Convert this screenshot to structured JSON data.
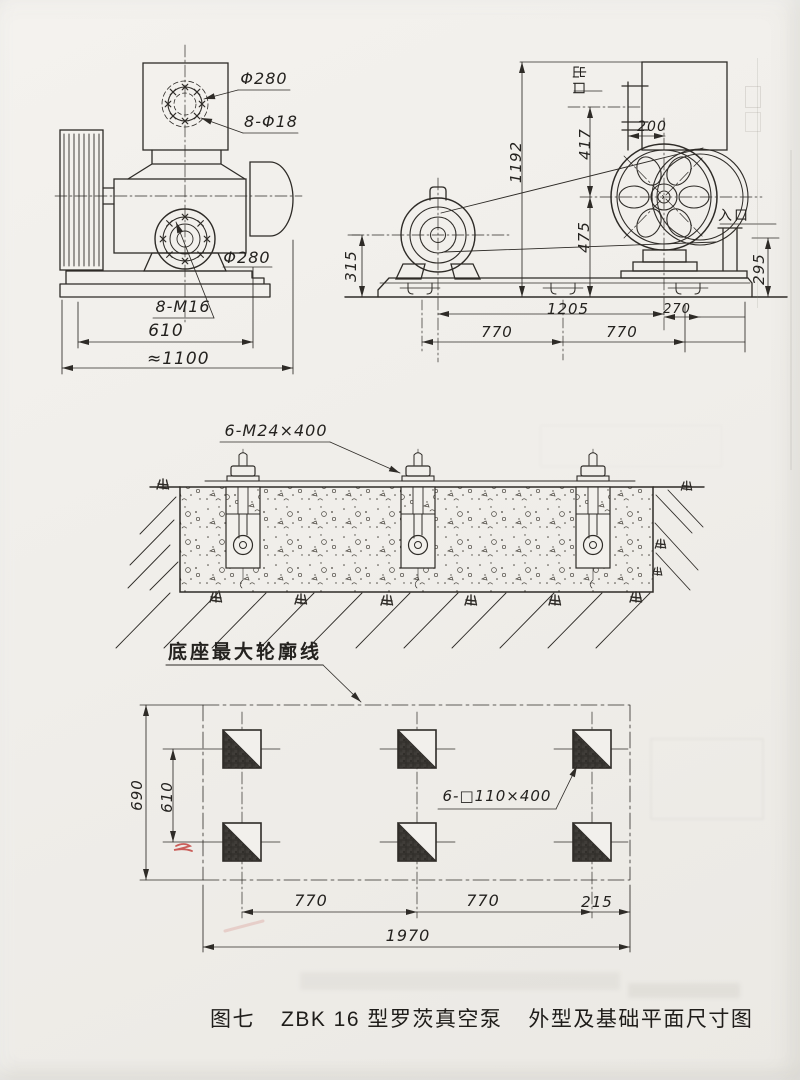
{
  "figure": {
    "number": "图七",
    "title": "ZBK 16 型罗茨真空泵",
    "subtitle": "外型及基础平面尺寸图"
  },
  "side_view": {
    "top_flange_dia": "Φ280",
    "top_flange_holes": "8-Φ18",
    "front_flange_dia": "Φ280",
    "front_flange_holes": "8-M16",
    "base_width": "610",
    "overall_width": "≈1100"
  },
  "front_view": {
    "outlet": "出口",
    "inlet": "入口",
    "overall_height": "1192",
    "outlet_center_height": "417",
    "outlet_offset": "200",
    "wheel_center_height": "475",
    "motor_center_height": "315",
    "inlet_center_height": "295",
    "center_distance": "1205",
    "overhang": "270",
    "bolt_span_1": "770",
    "bolt_span_2": "770"
  },
  "foundation_section": {
    "anchor_bolts": "6-M24×400"
  },
  "foundation_plan": {
    "outline_note": "底座最大轮廓线",
    "pockets": "6-□110×400",
    "length_total": "1970",
    "span_1": "770",
    "span_2": "770",
    "edge": "215",
    "width_total": "690",
    "row_span": "610"
  },
  "colors": {
    "ink": "#2e2b27",
    "paper": "#f0eeea",
    "red_pencil": "#c03a35"
  }
}
